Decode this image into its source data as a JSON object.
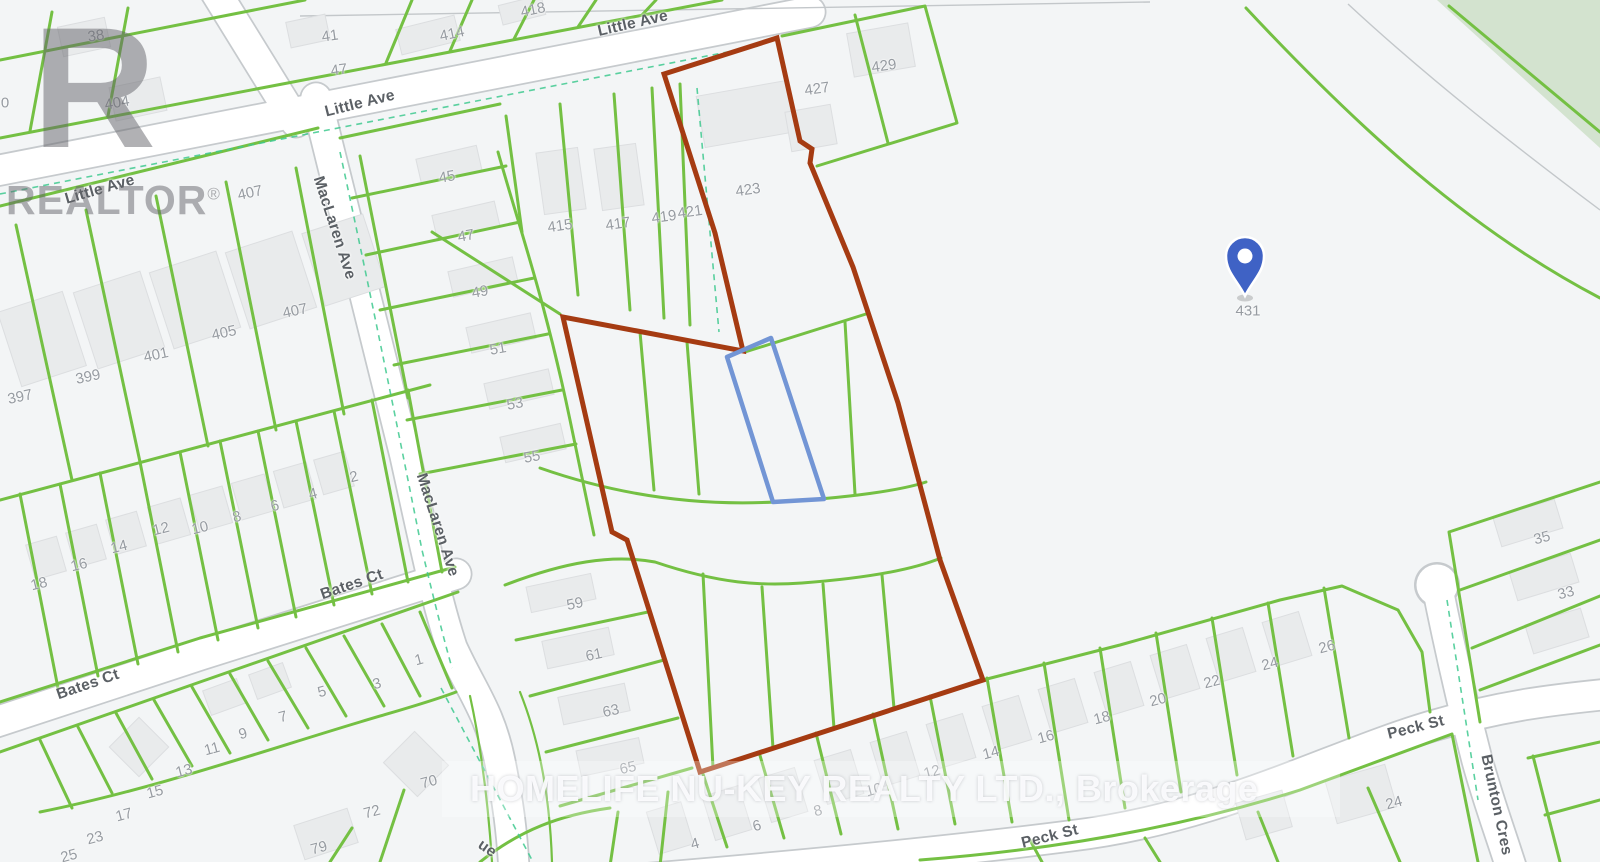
{
  "map": {
    "logo": {
      "letter": "R",
      "word": "REALTOR",
      "registered": "®"
    },
    "watermark_text": "HOMELIFE NU-KEY REALTY LTD., Brokerage",
    "pin": {
      "label": "431"
    },
    "colors": {
      "parcel_line": "#74c043",
      "boundary": "#a53b12",
      "highlight_lot": "#7295d5",
      "dashed_teal": "#3ec98f",
      "pin": "#3f62c5",
      "park": "#d3e3cf",
      "road_edge": "#c6cacd",
      "label": "#969ba1",
      "street_label": "#5b6065"
    },
    "street_labels": [
      {
        "t": "Little Ave",
        "x": 100,
        "y": 190,
        "r": -16
      },
      {
        "t": "Little Ave",
        "x": 360,
        "y": 104,
        "r": -14
      },
      {
        "t": "Little Ave",
        "x": 633,
        "y": 24,
        "r": -13
      },
      {
        "t": "MacLaren Ave",
        "x": 334,
        "y": 228,
        "r": 72
      },
      {
        "t": "MacLaren Ave",
        "x": 437,
        "y": 525,
        "r": 72
      },
      {
        "t": "Bates Ct",
        "x": 352,
        "y": 585,
        "r": -19
      },
      {
        "t": "Bates Ct",
        "x": 88,
        "y": 685,
        "r": -19
      },
      {
        "t": "Peck St",
        "x": 1050,
        "y": 837,
        "r": -14
      },
      {
        "t": "Peck St",
        "x": 1416,
        "y": 728,
        "r": -14
      },
      {
        "t": "Brunton Cres",
        "x": 1496,
        "y": 805,
        "r": 78
      },
      {
        "t": "ue",
        "x": 487,
        "y": 849,
        "r": 35
      }
    ],
    "lot_numbers": [
      {
        "t": "38",
        "x": 96,
        "y": 36,
        "r": -8
      },
      {
        "t": "404",
        "x": 117,
        "y": 103,
        "r": -10
      },
      {
        "t": "0",
        "x": 5,
        "y": 103,
        "r": 0
      },
      {
        "t": "41",
        "x": 330,
        "y": 36,
        "r": -8
      },
      {
        "t": "47",
        "x": 339,
        "y": 70,
        "r": -8
      },
      {
        "t": "414",
        "x": 452,
        "y": 34,
        "r": -12
      },
      {
        "t": "418",
        "x": 533,
        "y": 10,
        "r": -12
      },
      {
        "t": "407",
        "x": 250,
        "y": 193,
        "r": -12
      },
      {
        "t": "45",
        "x": 447,
        "y": 177,
        "r": -10
      },
      {
        "t": "47",
        "x": 466,
        "y": 236,
        "r": -10
      },
      {
        "t": "49",
        "x": 480,
        "y": 292,
        "r": -10
      },
      {
        "t": "51",
        "x": 498,
        "y": 349,
        "r": -10
      },
      {
        "t": "53",
        "x": 515,
        "y": 404,
        "r": -10
      },
      {
        "t": "55",
        "x": 532,
        "y": 457,
        "r": -10
      },
      {
        "t": "415",
        "x": 560,
        "y": 226,
        "r": -8
      },
      {
        "t": "417",
        "x": 618,
        "y": 224,
        "r": -8
      },
      {
        "t": "419",
        "x": 664,
        "y": 217,
        "r": -8
      },
      {
        "t": "421",
        "x": 690,
        "y": 212,
        "r": -8
      },
      {
        "t": "423",
        "x": 748,
        "y": 190,
        "r": -8
      },
      {
        "t": "427",
        "x": 817,
        "y": 89,
        "r": -8
      },
      {
        "t": "429",
        "x": 884,
        "y": 66,
        "r": -8
      },
      {
        "t": "397",
        "x": 20,
        "y": 397,
        "r": -12
      },
      {
        "t": "399",
        "x": 88,
        "y": 377,
        "r": -12
      },
      {
        "t": "401",
        "x": 156,
        "y": 355,
        "r": -12
      },
      {
        "t": "405",
        "x": 224,
        "y": 333,
        "r": -12
      },
      {
        "t": "407",
        "x": 295,
        "y": 311,
        "r": -12
      },
      {
        "t": "18",
        "x": 39,
        "y": 584,
        "r": -14
      },
      {
        "t": "16",
        "x": 79,
        "y": 565,
        "r": -14
      },
      {
        "t": "14",
        "x": 119,
        "y": 547,
        "r": -14
      },
      {
        "t": "12",
        "x": 161,
        "y": 529,
        "r": -14
      },
      {
        "t": "10",
        "x": 200,
        "y": 528,
        "r": -14
      },
      {
        "t": "8",
        "x": 237,
        "y": 517,
        "r": -14
      },
      {
        "t": "6",
        "x": 275,
        "y": 506,
        "r": -14
      },
      {
        "t": "4",
        "x": 313,
        "y": 494,
        "r": -14
      },
      {
        "t": "2",
        "x": 354,
        "y": 477,
        "r": -14
      },
      {
        "t": "1",
        "x": 419,
        "y": 660,
        "r": -15
      },
      {
        "t": "3",
        "x": 377,
        "y": 684,
        "r": -15
      },
      {
        "t": "5",
        "x": 322,
        "y": 692,
        "r": -15
      },
      {
        "t": "7",
        "x": 283,
        "y": 717,
        "r": -15
      },
      {
        "t": "9",
        "x": 243,
        "y": 734,
        "r": -15
      },
      {
        "t": "11",
        "x": 212,
        "y": 749,
        "r": -15
      },
      {
        "t": "13",
        "x": 184,
        "y": 771,
        "r": -15
      },
      {
        "t": "15",
        "x": 155,
        "y": 792,
        "r": -15
      },
      {
        "t": "17",
        "x": 124,
        "y": 815,
        "r": -15
      },
      {
        "t": "23",
        "x": 95,
        "y": 838,
        "r": -15
      },
      {
        "t": "25",
        "x": 69,
        "y": 856,
        "r": -15
      },
      {
        "t": "70",
        "x": 429,
        "y": 782,
        "r": -15
      },
      {
        "t": "72",
        "x": 372,
        "y": 812,
        "r": -15
      },
      {
        "t": "79",
        "x": 319,
        "y": 848,
        "r": -15
      },
      {
        "t": "59",
        "x": 575,
        "y": 604,
        "r": -12
      },
      {
        "t": "61",
        "x": 594,
        "y": 655,
        "r": -12
      },
      {
        "t": "63",
        "x": 611,
        "y": 711,
        "r": -12
      },
      {
        "t": "65",
        "x": 628,
        "y": 768,
        "r": -12
      },
      {
        "t": "4",
        "x": 695,
        "y": 844,
        "r": -15
      },
      {
        "t": "6",
        "x": 757,
        "y": 826,
        "r": -15
      },
      {
        "t": "8",
        "x": 818,
        "y": 811,
        "r": -15
      },
      {
        "t": "10",
        "x": 874,
        "y": 790,
        "r": -15
      },
      {
        "t": "12",
        "x": 932,
        "y": 772,
        "r": -15
      },
      {
        "t": "14",
        "x": 991,
        "y": 753,
        "r": -15
      },
      {
        "t": "16",
        "x": 1046,
        "y": 737,
        "r": -15
      },
      {
        "t": "18",
        "x": 1102,
        "y": 718,
        "r": -15
      },
      {
        "t": "20",
        "x": 1158,
        "y": 700,
        "r": -15
      },
      {
        "t": "22",
        "x": 1212,
        "y": 682,
        "r": -15
      },
      {
        "t": "24",
        "x": 1270,
        "y": 664,
        "r": -15
      },
      {
        "t": "26",
        "x": 1327,
        "y": 647,
        "r": -15
      },
      {
        "t": "35",
        "x": 1542,
        "y": 538,
        "r": -15
      },
      {
        "t": "33",
        "x": 1566,
        "y": 593,
        "r": -15
      },
      {
        "t": "24",
        "x": 1394,
        "y": 803,
        "r": -15
      }
    ]
  }
}
